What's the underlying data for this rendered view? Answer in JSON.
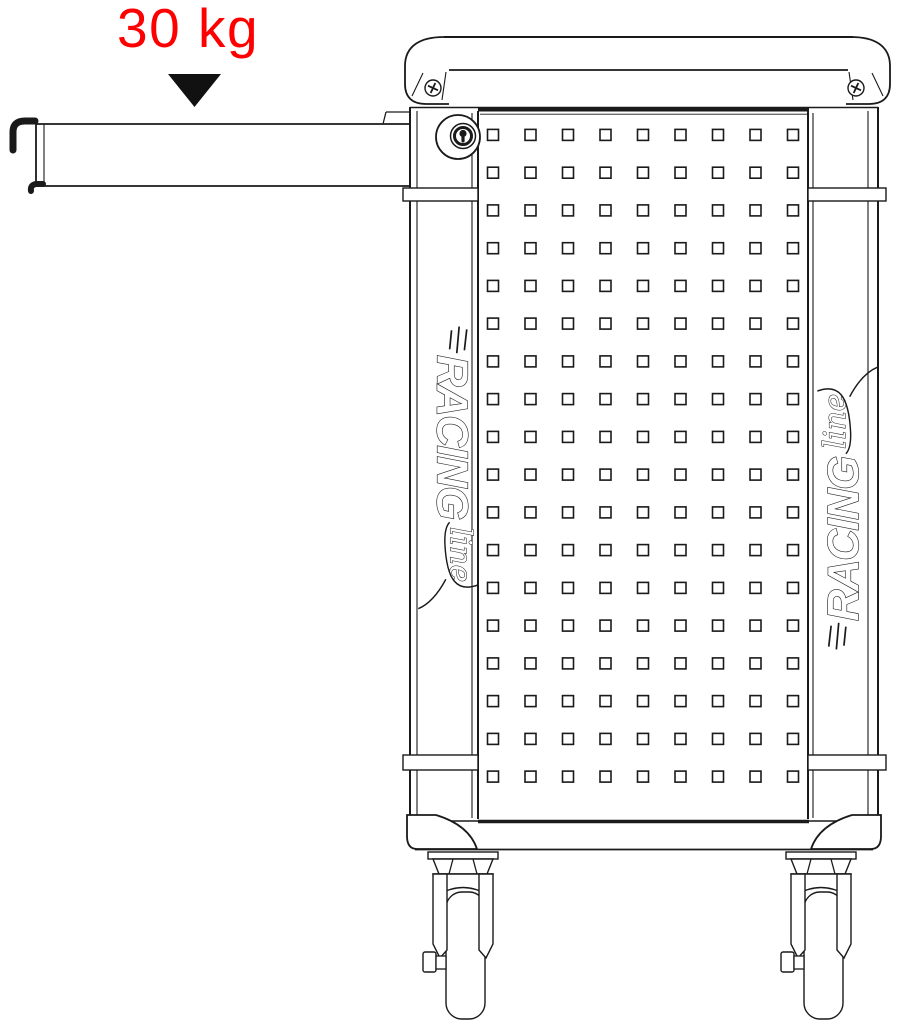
{
  "annotation": {
    "load_capacity": "30 kg",
    "label_color": "#ff0000",
    "arrow_color": "#111111"
  },
  "brand": {
    "racing": "RACING",
    "line": "line"
  },
  "pegboard": {
    "rows": 18,
    "cols": 9
  },
  "drawing": {
    "line_color": "#1a1a1a",
    "wheel_color": "#0e0e0e",
    "background": "#ffffff"
  }
}
